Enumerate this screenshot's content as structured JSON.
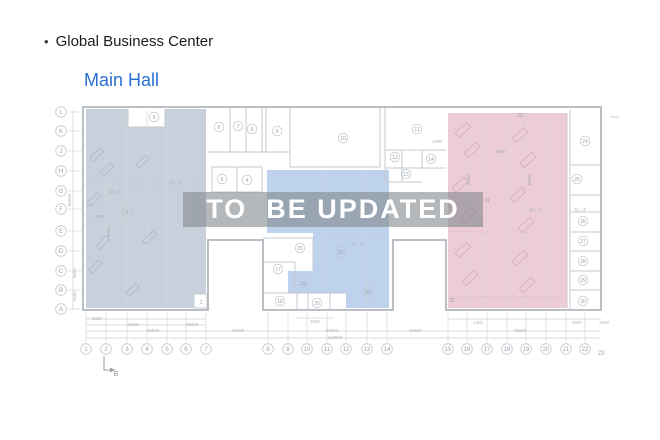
{
  "header": {
    "bullet": "•",
    "title": "Global Business Center",
    "subtitle": "Main Hall",
    "subtitle_color": "#2a6fd1"
  },
  "watermark": {
    "text": "TO  BE UPDATED",
    "band_color": "rgba(128,133,138,0.58)",
    "text_color": "#ffffff"
  },
  "plan": {
    "colors": {
      "left_zone_fill": "#c8d1db",
      "middle_zone_fill": "#bed2ee",
      "right_zone_fill": "#eccdd7",
      "outer_wall": "#b2b8bf",
      "inner_wall": "#c6cbd1"
    },
    "grid_rows": [
      {
        "label": "L",
        "x": 61,
        "y": 112
      },
      {
        "label": "K",
        "x": 61,
        "y": 131
      },
      {
        "label": "J",
        "x": 61,
        "y": 151
      },
      {
        "label": "H",
        "x": 61,
        "y": 171
      },
      {
        "label": "G",
        "x": 61,
        "y": 191
      },
      {
        "label": "F",
        "x": 61,
        "y": 209
      },
      {
        "label": "E",
        "x": 61,
        "y": 231
      },
      {
        "label": "D",
        "x": 61,
        "y": 251
      },
      {
        "label": "C",
        "x": 61,
        "y": 271
      },
      {
        "label": "B",
        "x": 61,
        "y": 290
      },
      {
        "label": "A",
        "x": 61,
        "y": 309
      }
    ],
    "grid_cols": [
      {
        "label": "1",
        "x": 86,
        "y": 349
      },
      {
        "label": "2",
        "x": 106,
        "y": 349
      },
      {
        "label": "3",
        "x": 127,
        "y": 349
      },
      {
        "label": "4",
        "x": 147,
        "y": 349
      },
      {
        "label": "5",
        "x": 167,
        "y": 349
      },
      {
        "label": "6",
        "x": 186,
        "y": 349
      },
      {
        "label": "7",
        "x": 206,
        "y": 349
      },
      {
        "label": "8",
        "x": 268,
        "y": 349
      },
      {
        "label": "9",
        "x": 288,
        "y": 349
      },
      {
        "label": "10",
        "x": 307,
        "y": 349
      },
      {
        "label": "11",
        "x": 327,
        "y": 349
      },
      {
        "label": "12",
        "x": 346,
        "y": 349
      },
      {
        "label": "13",
        "x": 367,
        "y": 349
      },
      {
        "label": "14",
        "x": 387,
        "y": 349
      },
      {
        "label": "15",
        "x": 448,
        "y": 349
      },
      {
        "label": "16",
        "x": 467,
        "y": 349
      },
      {
        "label": "17",
        "x": 487,
        "y": 349
      },
      {
        "label": "18",
        "x": 507,
        "y": 349
      },
      {
        "label": "19",
        "x": 526,
        "y": 349
      },
      {
        "label": "20",
        "x": 546,
        "y": 349
      },
      {
        "label": "21",
        "x": 566,
        "y": 349
      },
      {
        "label": "22",
        "x": 585,
        "y": 349
      },
      {
        "label": "23",
        "x": 601,
        "y": 353,
        "circle": false
      }
    ],
    "rooms": [
      {
        "label": "1",
        "x": 201,
        "y": 302,
        "circle": false
      },
      {
        "label": "2",
        "x": 127,
        "y": 212
      },
      {
        "label": "3",
        "x": 154,
        "y": 117
      },
      {
        "label": "4",
        "x": 247,
        "y": 180
      },
      {
        "label": "5",
        "x": 222,
        "y": 179
      },
      {
        "label": "6",
        "x": 219,
        "y": 127
      },
      {
        "label": "7",
        "x": 238,
        "y": 126
      },
      {
        "label": "8",
        "x": 252,
        "y": 129
      },
      {
        "label": "9",
        "x": 277,
        "y": 131
      },
      {
        "label": "10",
        "x": 343,
        "y": 138
      },
      {
        "label": "11",
        "x": 417,
        "y": 129
      },
      {
        "label": "12",
        "x": 395,
        "y": 157
      },
      {
        "label": "13",
        "x": 406,
        "y": 174
      },
      {
        "label": "14",
        "x": 431,
        "y": 159
      },
      {
        "label": "15",
        "x": 300,
        "y": 248
      },
      {
        "label": "17",
        "x": 278,
        "y": 269
      },
      {
        "label": "18",
        "x": 280,
        "y": 301
      },
      {
        "label": "19",
        "x": 303,
        "y": 283
      },
      {
        "label": "20",
        "x": 317,
        "y": 303
      },
      {
        "label": "21",
        "x": 341,
        "y": 252
      },
      {
        "label": "22",
        "x": 368,
        "y": 292
      },
      {
        "label": "23",
        "x": 520,
        "y": 115,
        "circle": false
      },
      {
        "label": "24",
        "x": 585,
        "y": 141
      },
      {
        "label": "25",
        "x": 577,
        "y": 179
      },
      {
        "label": "26",
        "x": 583,
        "y": 221
      },
      {
        "label": "27",
        "x": 583,
        "y": 241
      },
      {
        "label": "28",
        "x": 583,
        "y": 261
      },
      {
        "label": "29",
        "x": 583,
        "y": 280
      },
      {
        "label": "30",
        "x": 583,
        "y": 301
      },
      {
        "label": "31",
        "x": 487,
        "y": 200,
        "circle": false
      },
      {
        "label": "32",
        "x": 452,
        "y": 300,
        "circle": false
      }
    ],
    "annotations": [
      {
        "label": "Q = 3",
        "x": 175,
        "y": 184
      },
      {
        "label": "Q = 3",
        "x": 115,
        "y": 193
      },
      {
        "label": "Q = 3",
        "x": 357,
        "y": 245
      },
      {
        "label": "Q = 3",
        "x": 535,
        "y": 211
      },
      {
        "label": "Q = 3",
        "x": 477,
        "y": 226
      },
      {
        "label": "Q = 3",
        "x": 580,
        "y": 211
      },
      {
        "label": "2693",
        "x": 100,
        "y": 218
      },
      {
        "label": "1800",
        "x": 500,
        "y": 153
      },
      {
        "label": "1300",
        "x": 437,
        "y": 143
      },
      {
        "label": "6000",
        "x": 470,
        "y": 180,
        "vertical": true
      },
      {
        "label": "6000",
        "x": 531,
        "y": 180,
        "vertical": true
      },
      {
        "label": "6000",
        "x": 110,
        "y": 232,
        "vertical": true
      }
    ],
    "dimensions": [
      {
        "label": "6000",
        "x": 97,
        "y": 320
      },
      {
        "label": "18000",
        "x": 133,
        "y": 326
      },
      {
        "label": "18000",
        "x": 192,
        "y": 326
      },
      {
        "label": "36000",
        "x": 153,
        "y": 332
      },
      {
        "label": "18000",
        "x": 238,
        "y": 332
      },
      {
        "label": "2000",
        "x": 315,
        "y": 323
      },
      {
        "label": "36000",
        "x": 332,
        "y": 332
      },
      {
        "label": "153600",
        "x": 335,
        "y": 339
      },
      {
        "label": "18400",
        "x": 415,
        "y": 332
      },
      {
        "label": "1300",
        "x": 478,
        "y": 324
      },
      {
        "label": "45000",
        "x": 520,
        "y": 332
      },
      {
        "label": "6000",
        "x": 577,
        "y": 324
      },
      {
        "label": "3000",
        "x": 604,
        "y": 324
      },
      {
        "label": "60000",
        "x": 71,
        "y": 200,
        "vertical": true
      },
      {
        "label": "6000",
        "x": 76,
        "y": 273,
        "vertical": true
      },
      {
        "label": "6000",
        "x": 76,
        "y": 296,
        "vertical": true
      }
    ],
    "section_marker": {
      "label": "B",
      "x": 116,
      "y": 376
    }
  }
}
